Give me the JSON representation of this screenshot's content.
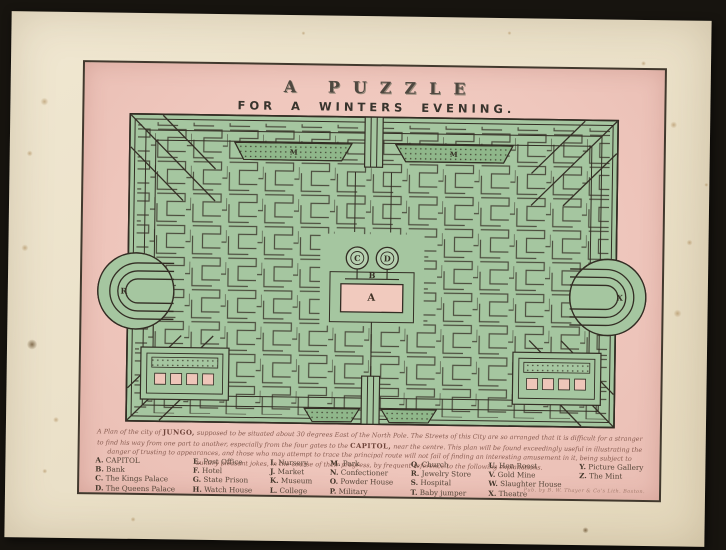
{
  "print": {
    "title_line1": "A PUZZLE",
    "title_line2": "FOR A WINTERS EVENING.",
    "description": {
      "lead": "A Plan of the city of ",
      "city": "JUNGO,",
      "mid": " supposed to be situated about 30 degrees East of the North Pole. The Streets of this City are so arranged that it is difficult for a stranger to find his way from one part to another, especially from the four gates to the ",
      "capitol": "CAPITOL,",
      "tail": " near the centre. This plan will be found exceedingly useful in illustrating the danger of trusting to appearances, and those who may attempt to trace the principal route will not fail of finding an interesting amusement in it, being subject to sundry pleasant jokes, in the course of their progress, by frequent reference to the following explanations."
    },
    "imprint": "Pub. by B. W. Thayer & Co's Lith. Boston.",
    "maze_markers": [
      {
        "label": "A"
      },
      {
        "label": "B"
      },
      {
        "label": "C"
      },
      {
        "label": "D"
      },
      {
        "label": "M"
      },
      {
        "label": "M"
      },
      {
        "label": "R"
      },
      {
        "label": "X"
      }
    ],
    "legend": {
      "columns": [
        {
          "entries": [
            {
              "letter": "A.",
              "name": "CAPITOL"
            },
            {
              "letter": "B.",
              "name": "Bank"
            },
            {
              "letter": "C.",
              "name": "The Kings Palace"
            },
            {
              "letter": "D.",
              "name": "The Queens Palace"
            }
          ]
        },
        {
          "entries": [
            {
              "letter": "E.",
              "name": "Post Office"
            },
            {
              "letter": "F.",
              "name": "Hotel"
            },
            {
              "letter": "G.",
              "name": "State Prison"
            },
            {
              "letter": "H.",
              "name": "Watch House"
            }
          ]
        },
        {
          "entries": [
            {
              "letter": "I.",
              "name": "Nursery"
            },
            {
              "letter": "J.",
              "name": "Market"
            },
            {
              "letter": "K.",
              "name": "Museum"
            },
            {
              "letter": "L.",
              "name": "College"
            }
          ]
        },
        {
          "entries": [
            {
              "letter": "M.",
              "name": "Park"
            },
            {
              "letter": "N.",
              "name": "Confectioner"
            },
            {
              "letter": "O.",
              "name": "Powder House"
            },
            {
              "letter": "P.",
              "name": "Military"
            }
          ]
        },
        {
          "entries": [
            {
              "letter": "Q.",
              "name": "Church"
            },
            {
              "letter": "R.",
              "name": "Jewelry Store"
            },
            {
              "letter": "S.",
              "name": "Hospital"
            },
            {
              "letter": "T.",
              "name": "Baby jumper"
            }
          ]
        },
        {
          "entries": [
            {
              "letter": "U.",
              "name": "Hen Roost"
            },
            {
              "letter": "V.",
              "name": "Gold Mine"
            },
            {
              "letter": "W.",
              "name": "Slaughter House"
            },
            {
              "letter": "X.",
              "name": "Theatre"
            }
          ]
        },
        {
          "entries": [
            {
              "letter": "Y.",
              "name": "Picture Gallery"
            },
            {
              "letter": "Z.",
              "name": "The Mint"
            }
          ]
        }
      ]
    },
    "colors": {
      "backdrop": "#17140f",
      "paper": "#ebe1c9",
      "panel_pink": "#efc7bd",
      "maze_green": "#a5c6a0",
      "ink": "#332d24"
    }
  }
}
